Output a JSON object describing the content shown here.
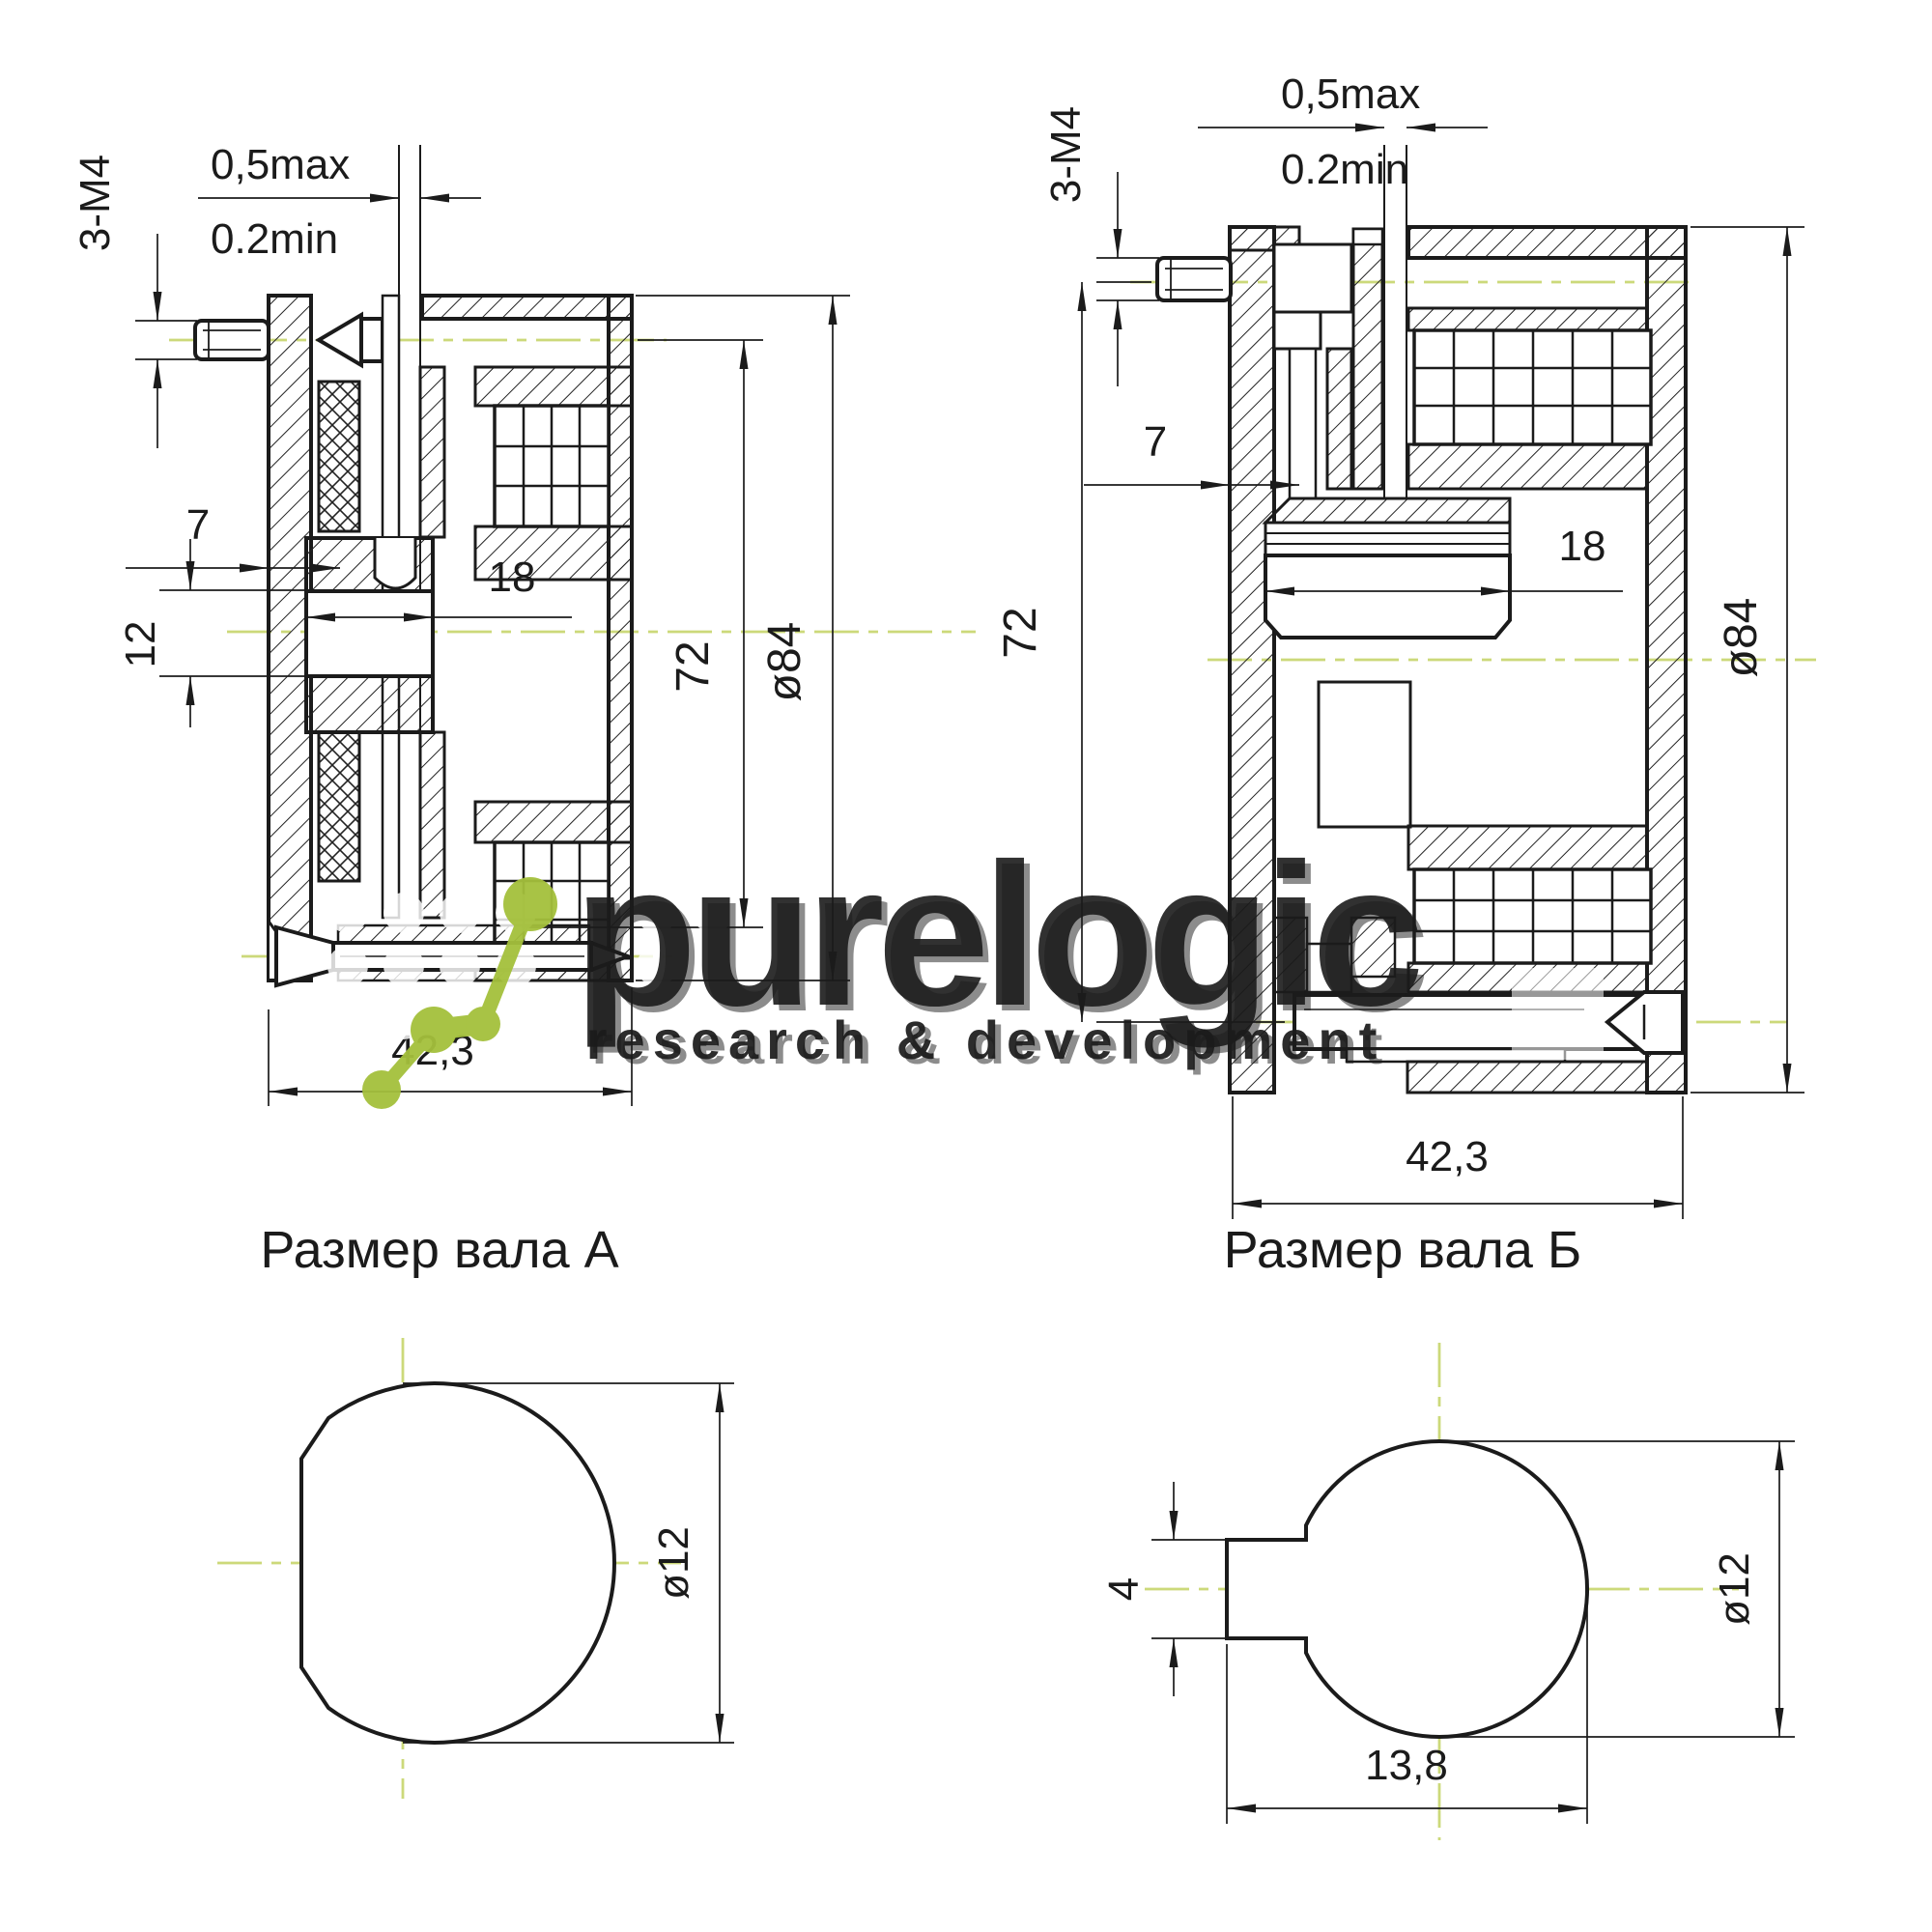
{
  "views": {
    "left_section": {
      "labels": {
        "thread": "3-M4",
        "gap_max": "0,5max",
        "gap_min": "0.2min",
        "offset7": "7",
        "dia12": "12",
        "len18": "18",
        "dia72": "72",
        "dia84": "ø84",
        "length": "42,3"
      }
    },
    "right_section": {
      "labels": {
        "thread": "3-M4",
        "gap_max": "0,5max",
        "gap_min": "0.2min",
        "offset7": "7",
        "len18": "18",
        "dia72": "72",
        "dia84": "ø84",
        "length": "42,3"
      }
    },
    "shaft_a": {
      "title": "Размер вала А",
      "dia": "ø12"
    },
    "shaft_b": {
      "title": "Размер вала Б",
      "dia": "ø12",
      "key_height": "4",
      "key_length": "13,8"
    }
  },
  "watermark": {
    "brand": "purelogic",
    "tagline": "research & development"
  },
  "colors": {
    "line": "#1b1b1b",
    "centerline": "#ccd97a",
    "logo_green": "#a4c03c",
    "watermark_text": "#ffffff"
  }
}
